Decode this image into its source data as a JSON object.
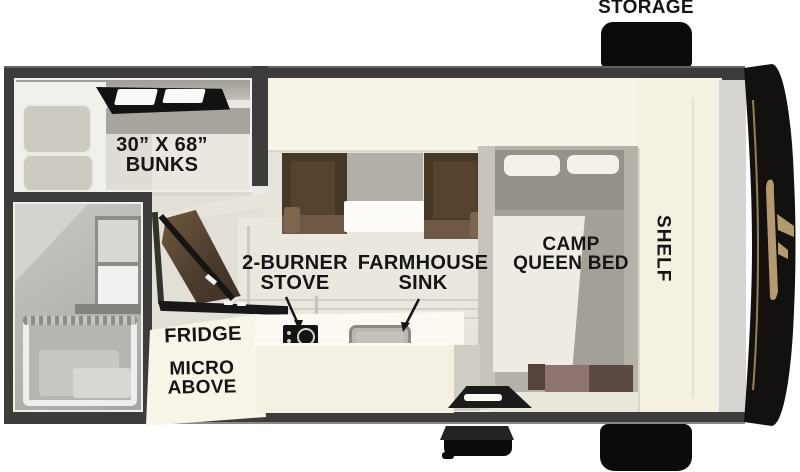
{
  "floorplan": {
    "title": "truck camper floor plan",
    "labels": {
      "storage": "STORAGE",
      "bunks": {
        "line1": "30” X 68”",
        "line2": "BUNKS"
      },
      "stove": {
        "line1": "2-BURNER",
        "line2": "STOVE"
      },
      "sink": {
        "line1": "FARMHOUSE",
        "line2": "SINK"
      },
      "fridge": "FRIDGE",
      "micro": {
        "line1": "MICRO",
        "line2": "ABOVE"
      },
      "bed": {
        "line1": "CAMP",
        "line2": "QUEEN BED"
      },
      "shelf": "SHELF"
    },
    "colors": {
      "background": "#ffffff",
      "wall": "#3d3c3a",
      "interior_floor": "#dcd9d2",
      "cabinet_cream": "#f6f3e6",
      "bench_brown": "#473727",
      "bed_gray": "#a4a098",
      "blanket_white": "#edebe3",
      "exterior_black": "#100f0d",
      "brand_tan": "#b49a6e",
      "label_text": "#161514"
    }
  }
}
